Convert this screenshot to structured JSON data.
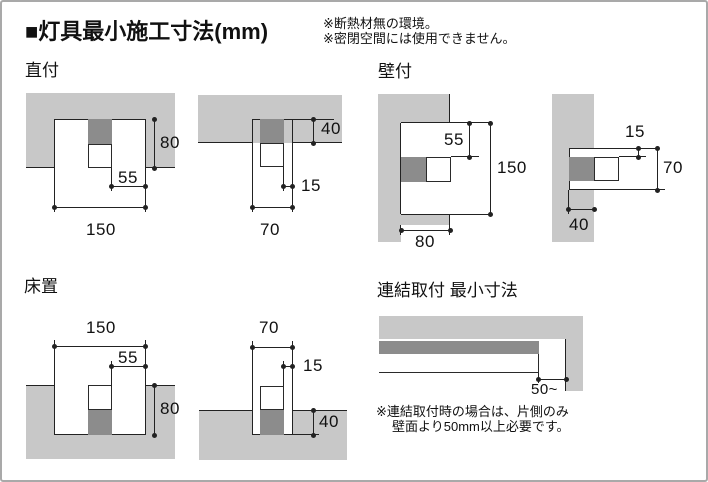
{
  "header": {
    "title": "■灯具最小施工寸法(mm)",
    "note1": "※断熱材無の環境。",
    "note2": "※密閉空間には使用できません。"
  },
  "colors": {
    "slab": "#c8c8c8",
    "fixture_dark": "#8c8c8c",
    "line": "#222222"
  },
  "sections": {
    "chokuzuke": {
      "label": "直付",
      "wide": {
        "depth": "80",
        "side": "55",
        "width": "150"
      },
      "narrow": {
        "thickness": "40",
        "side": "15",
        "width": "70"
      }
    },
    "kabezuke": {
      "label": "壁付",
      "wide": {
        "top": "55",
        "height": "150",
        "depth": "80"
      },
      "narrow": {
        "top": "15",
        "height": "70",
        "depth": "40"
      }
    },
    "yukaoki": {
      "label": "床置",
      "wide": {
        "width": "150",
        "side": "55",
        "depth": "80"
      },
      "narrow": {
        "width": "70",
        "side": "15",
        "depth": "40"
      }
    },
    "renketsu": {
      "label": "連結取付 最小寸法",
      "clearance": "50~",
      "note1": "※連結取付時の場合は、片側のみ",
      "note2": "壁面より50mm以上必要です。"
    }
  }
}
